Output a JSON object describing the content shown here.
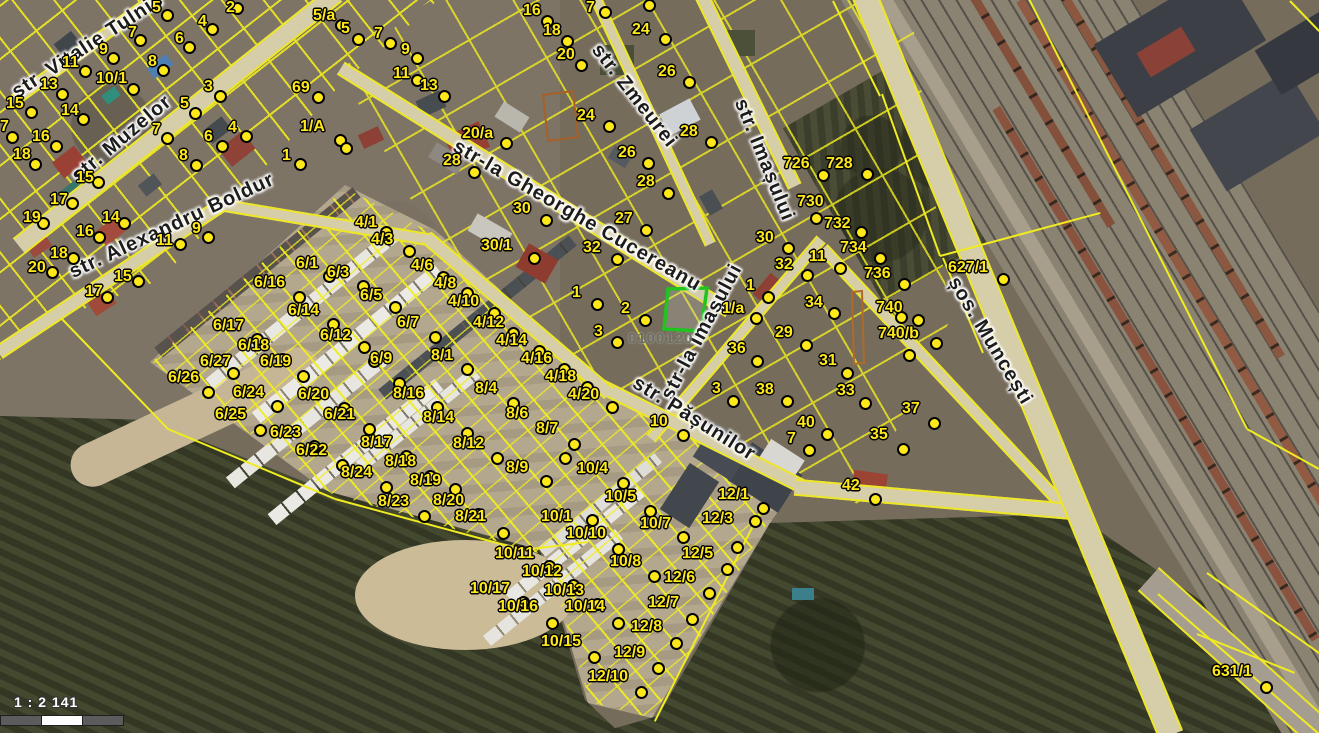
{
  "map": {
    "scale_text": "1 : 2 141",
    "selected_parcel_id": "0100120",
    "overlay_color": "#f0ec20",
    "marker_color": "#ffe81a",
    "selected_parcel_outline": "#1fc41f",
    "streets": [
      {
        "name": "str. Vitalie Tulnic",
        "x": 88,
        "y": 46,
        "rot": -33
      },
      {
        "name": "str. Muzelor",
        "x": 122,
        "y": 139,
        "rot": -40
      },
      {
        "name": "str. Alexandru Boldur",
        "x": 172,
        "y": 226,
        "rot": -25
      },
      {
        "name": "str-la Gheorghe Cucereanu",
        "x": 577,
        "y": 216,
        "rot": 30
      },
      {
        "name": "str. Zmeurei",
        "x": 634,
        "y": 96,
        "rot": 52
      },
      {
        "name": "str. Imașului",
        "x": 764,
        "y": 160,
        "rot": 68
      },
      {
        "name": "str-la Imașului",
        "x": 702,
        "y": 332,
        "rot": -62
      },
      {
        "name": "str. Pășunilor",
        "x": 694,
        "y": 419,
        "rot": 32
      },
      {
        "name": "șos. Muncești",
        "x": 990,
        "y": 341,
        "rot": 59
      }
    ],
    "markers": [
      [
        "5",
        152,
        0,
        167,
        15
      ],
      [
        "2",
        226,
        0,
        237,
        8
      ],
      [
        "4",
        198,
        14,
        212,
        29
      ],
      [
        "7",
        128,
        25,
        140,
        40
      ],
      [
        "6",
        175,
        31,
        189,
        47
      ],
      [
        "9",
        99,
        42,
        113,
        58
      ],
      [
        "8",
        148,
        54,
        163,
        70
      ],
      [
        "11",
        62,
        55,
        85,
        71
      ],
      [
        "13",
        40,
        77,
        62,
        94
      ],
      [
        "10/1",
        96,
        71,
        133,
        89
      ],
      [
        "15",
        6,
        96,
        31,
        112
      ],
      [
        "14",
        61,
        103,
        83,
        119
      ],
      [
        "7",
        0,
        119,
        12,
        137
      ],
      [
        "16",
        32,
        129,
        56,
        146
      ],
      [
        "18",
        13,
        147,
        35,
        164
      ],
      [
        "3",
        204,
        79,
        220,
        96
      ],
      [
        "5",
        180,
        96,
        195,
        113
      ],
      [
        "69",
        292,
        80,
        318,
        97
      ],
      [
        "7",
        152,
        122,
        167,
        138
      ],
      [
        "4",
        228,
        120,
        246,
        136
      ],
      [
        "6",
        204,
        129,
        222,
        146
      ],
      [
        "1/A",
        300,
        119,
        340,
        140
      ],
      [
        "8",
        179,
        148,
        196,
        165
      ],
      [
        "1",
        282,
        148,
        300,
        164
      ],
      [
        "15",
        76,
        170,
        98,
        182
      ],
      [
        "17",
        50,
        192,
        72,
        203
      ],
      [
        "19",
        23,
        210,
        43,
        223
      ],
      [
        "16",
        76,
        224,
        99,
        237
      ],
      [
        "14",
        102,
        210,
        124,
        223
      ],
      [
        "11",
        156,
        233,
        180,
        244
      ],
      [
        "9",
        192,
        221,
        208,
        237
      ],
      [
        "18",
        50,
        246,
        73,
        258
      ],
      [
        "20",
        28,
        260,
        52,
        272
      ],
      [
        "15",
        114,
        269,
        138,
        281
      ],
      [
        "17",
        85,
        284,
        107,
        297
      ],
      [
        "5/a",
        313,
        8,
        341,
        25
      ],
      [
        "5",
        341,
        21,
        358,
        39
      ],
      [
        "7",
        374,
        26,
        390,
        43
      ],
      [
        "9",
        401,
        42,
        417,
        58
      ],
      [
        "11",
        393,
        66,
        417,
        80
      ],
      [
        "13",
        420,
        78,
        444,
        96
      ],
      [
        "16",
        523,
        3,
        547,
        21
      ],
      [
        "18",
        543,
        23,
        567,
        41
      ],
      [
        "20",
        557,
        47,
        581,
        65
      ],
      [
        "7",
        586,
        0,
        605,
        12
      ],
      [
        "24",
        632,
        22,
        665,
        39
      ],
      [
        "26",
        658,
        64,
        689,
        82
      ],
      [
        "24",
        577,
        108,
        609,
        126
      ],
      [
        "28",
        680,
        124,
        711,
        142
      ],
      [
        "26",
        618,
        145,
        648,
        163
      ],
      [
        "28",
        637,
        174,
        668,
        193
      ],
      [
        "27",
        615,
        211,
        646,
        230
      ],
      [
        "20/a",
        462,
        126,
        506,
        143
      ],
      [
        "28",
        443,
        153,
        474,
        172
      ],
      [
        "30",
        513,
        201,
        546,
        220
      ],
      [
        "30/1",
        481,
        238,
        534,
        258
      ],
      [
        "32",
        583,
        240,
        617,
        259
      ],
      [
        "726",
        783,
        156,
        823,
        175
      ],
      [
        "728",
        826,
        156,
        867,
        174
      ],
      [
        "730",
        797,
        194,
        816,
        218
      ],
      [
        "732",
        824,
        216,
        861,
        232
      ],
      [
        "734",
        840,
        240,
        880,
        258
      ],
      [
        "736",
        864,
        266,
        904,
        284
      ],
      [
        "740",
        876,
        300,
        901,
        317
      ],
      [
        "740/b",
        878,
        326,
        936,
        343
      ],
      [
        "627/1",
        948,
        260,
        1003,
        279
      ],
      [
        "631/1",
        1212,
        664,
        1266,
        687
      ],
      [
        "30",
        756,
        230,
        788,
        248
      ],
      [
        "32",
        775,
        257,
        807,
        275
      ],
      [
        "11",
        809,
        249,
        840,
        268
      ],
      [
        "1",
        746,
        278,
        768,
        297
      ],
      [
        "1/a",
        722,
        301,
        756,
        318
      ],
      [
        "34",
        805,
        295,
        834,
        313
      ],
      [
        "29",
        775,
        325,
        806,
        345
      ],
      [
        "36",
        728,
        341,
        757,
        361
      ],
      [
        "31",
        819,
        353,
        847,
        373
      ],
      [
        "3",
        712,
        381,
        733,
        401
      ],
      [
        "38",
        756,
        382,
        787,
        401
      ],
      [
        "33",
        837,
        383,
        865,
        403
      ],
      [
        "37",
        902,
        401,
        934,
        423
      ],
      [
        "40",
        797,
        415,
        827,
        434
      ],
      [
        "7",
        787,
        431,
        809,
        450
      ],
      [
        "35",
        870,
        427,
        903,
        449
      ],
      [
        "42",
        842,
        478,
        875,
        499
      ],
      [
        "10",
        650,
        414,
        683,
        435
      ],
      [
        "1",
        572,
        285,
        597,
        304
      ],
      [
        "2",
        621,
        301,
        645,
        320
      ],
      [
        "3",
        594,
        324,
        617,
        342
      ],
      [
        "4/1",
        355,
        215,
        386,
        232
      ],
      [
        "4/3",
        371,
        232,
        409,
        251
      ],
      [
        "4/6",
        411,
        258,
        443,
        277
      ],
      [
        "4/8",
        434,
        276,
        467,
        293
      ],
      [
        "4/10",
        448,
        294,
        494,
        313
      ],
      [
        "4/12",
        473,
        315,
        513,
        333
      ],
      [
        "4/14",
        496,
        333,
        539,
        351
      ],
      [
        "4/16",
        521,
        351,
        564,
        369
      ],
      [
        "4/18",
        545,
        369,
        587,
        387
      ],
      [
        "4/20",
        568,
        387,
        612,
        407
      ],
      [
        "6/1",
        296,
        256,
        329,
        276
      ],
      [
        "6/3",
        327,
        265,
        363,
        286
      ],
      [
        "6/16",
        254,
        275,
        299,
        297
      ],
      [
        "6/5",
        360,
        288,
        395,
        307
      ],
      [
        "6/14",
        288,
        303,
        333,
        324
      ],
      [
        "6/7",
        397,
        315,
        435,
        337
      ],
      [
        "6/17",
        213,
        318,
        257,
        339
      ],
      [
        "6/12",
        320,
        328,
        364,
        347
      ],
      [
        "6/18",
        238,
        338,
        282,
        359
      ],
      [
        "6/19",
        260,
        354,
        303,
        376
      ],
      [
        "6/9",
        370,
        351,
        399,
        383
      ],
      [
        "6/27",
        200,
        354,
        233,
        373
      ],
      [
        "6/26",
        168,
        370,
        208,
        392
      ],
      [
        "6/24",
        233,
        385,
        277,
        406
      ],
      [
        "6/20",
        298,
        387,
        344,
        408
      ],
      [
        "6/25",
        215,
        407,
        260,
        430
      ],
      [
        "6/21",
        324,
        407,
        369,
        429
      ],
      [
        "6/23",
        270,
        425,
        314,
        446
      ],
      [
        "6/22",
        296,
        443,
        342,
        465
      ],
      [
        "8/1",
        431,
        348,
        467,
        369
      ],
      [
        "8/16",
        393,
        386,
        437,
        407
      ],
      [
        "8/4",
        475,
        381,
        513,
        403
      ],
      [
        "8/14",
        423,
        410,
        467,
        433
      ],
      [
        "8/6",
        506,
        406,
        543,
        428
      ],
      [
        "8/7",
        536,
        421,
        574,
        444
      ],
      [
        "8/12",
        453,
        436,
        497,
        458
      ],
      [
        "8/17",
        361,
        435,
        406,
        456
      ],
      [
        "8/18",
        385,
        454,
        430,
        476
      ],
      [
        "8/24",
        341,
        465,
        386,
        487
      ],
      [
        "8/19",
        410,
        473,
        455,
        489
      ],
      [
        "8/20",
        433,
        493,
        478,
        514
      ],
      [
        "8/23",
        378,
        494,
        424,
        516
      ],
      [
        "8/21",
        455,
        509,
        503,
        533
      ],
      [
        "8/9",
        506,
        460,
        546,
        481
      ],
      [
        "10/4",
        577,
        461,
        623,
        483
      ],
      [
        "10/5",
        605,
        489,
        650,
        511
      ],
      [
        "10/1",
        541,
        509,
        592,
        520
      ],
      [
        "10/7",
        640,
        516,
        683,
        537
      ],
      [
        "10/10",
        566,
        526,
        618,
        549
      ],
      [
        "10/8",
        610,
        554,
        654,
        576
      ],
      [
        "10/11",
        495,
        546,
        549,
        566
      ],
      [
        "10/12",
        522,
        564,
        573,
        585
      ],
      [
        "10/17",
        470,
        581,
        523,
        602
      ],
      [
        "10/13",
        544,
        583,
        597,
        604
      ],
      [
        "10/16",
        498,
        599,
        552,
        623
      ],
      [
        "10/14",
        565,
        599,
        618,
        623
      ],
      [
        "10/15",
        541,
        634,
        594,
        657
      ],
      [
        "12/1",
        718,
        487,
        763,
        508
      ],
      [
        "12/3",
        702,
        511,
        755,
        521
      ],
      [
        "12/5",
        682,
        546,
        727,
        569
      ],
      [
        "12/6",
        664,
        570,
        709,
        593
      ],
      [
        "12/7",
        648,
        595,
        692,
        619
      ],
      [
        "12/8",
        631,
        619,
        676,
        643
      ],
      [
        "12/9",
        614,
        645,
        658,
        668
      ],
      [
        "12/10",
        588,
        669,
        641,
        692
      ]
    ],
    "extra_dots": [
      [
        649,
        5
      ],
      [
        346,
        148
      ],
      [
        918,
        320
      ],
      [
        909,
        355
      ],
      [
        737,
        547
      ],
      [
        565,
        458
      ],
      [
        374,
        361
      ]
    ]
  }
}
